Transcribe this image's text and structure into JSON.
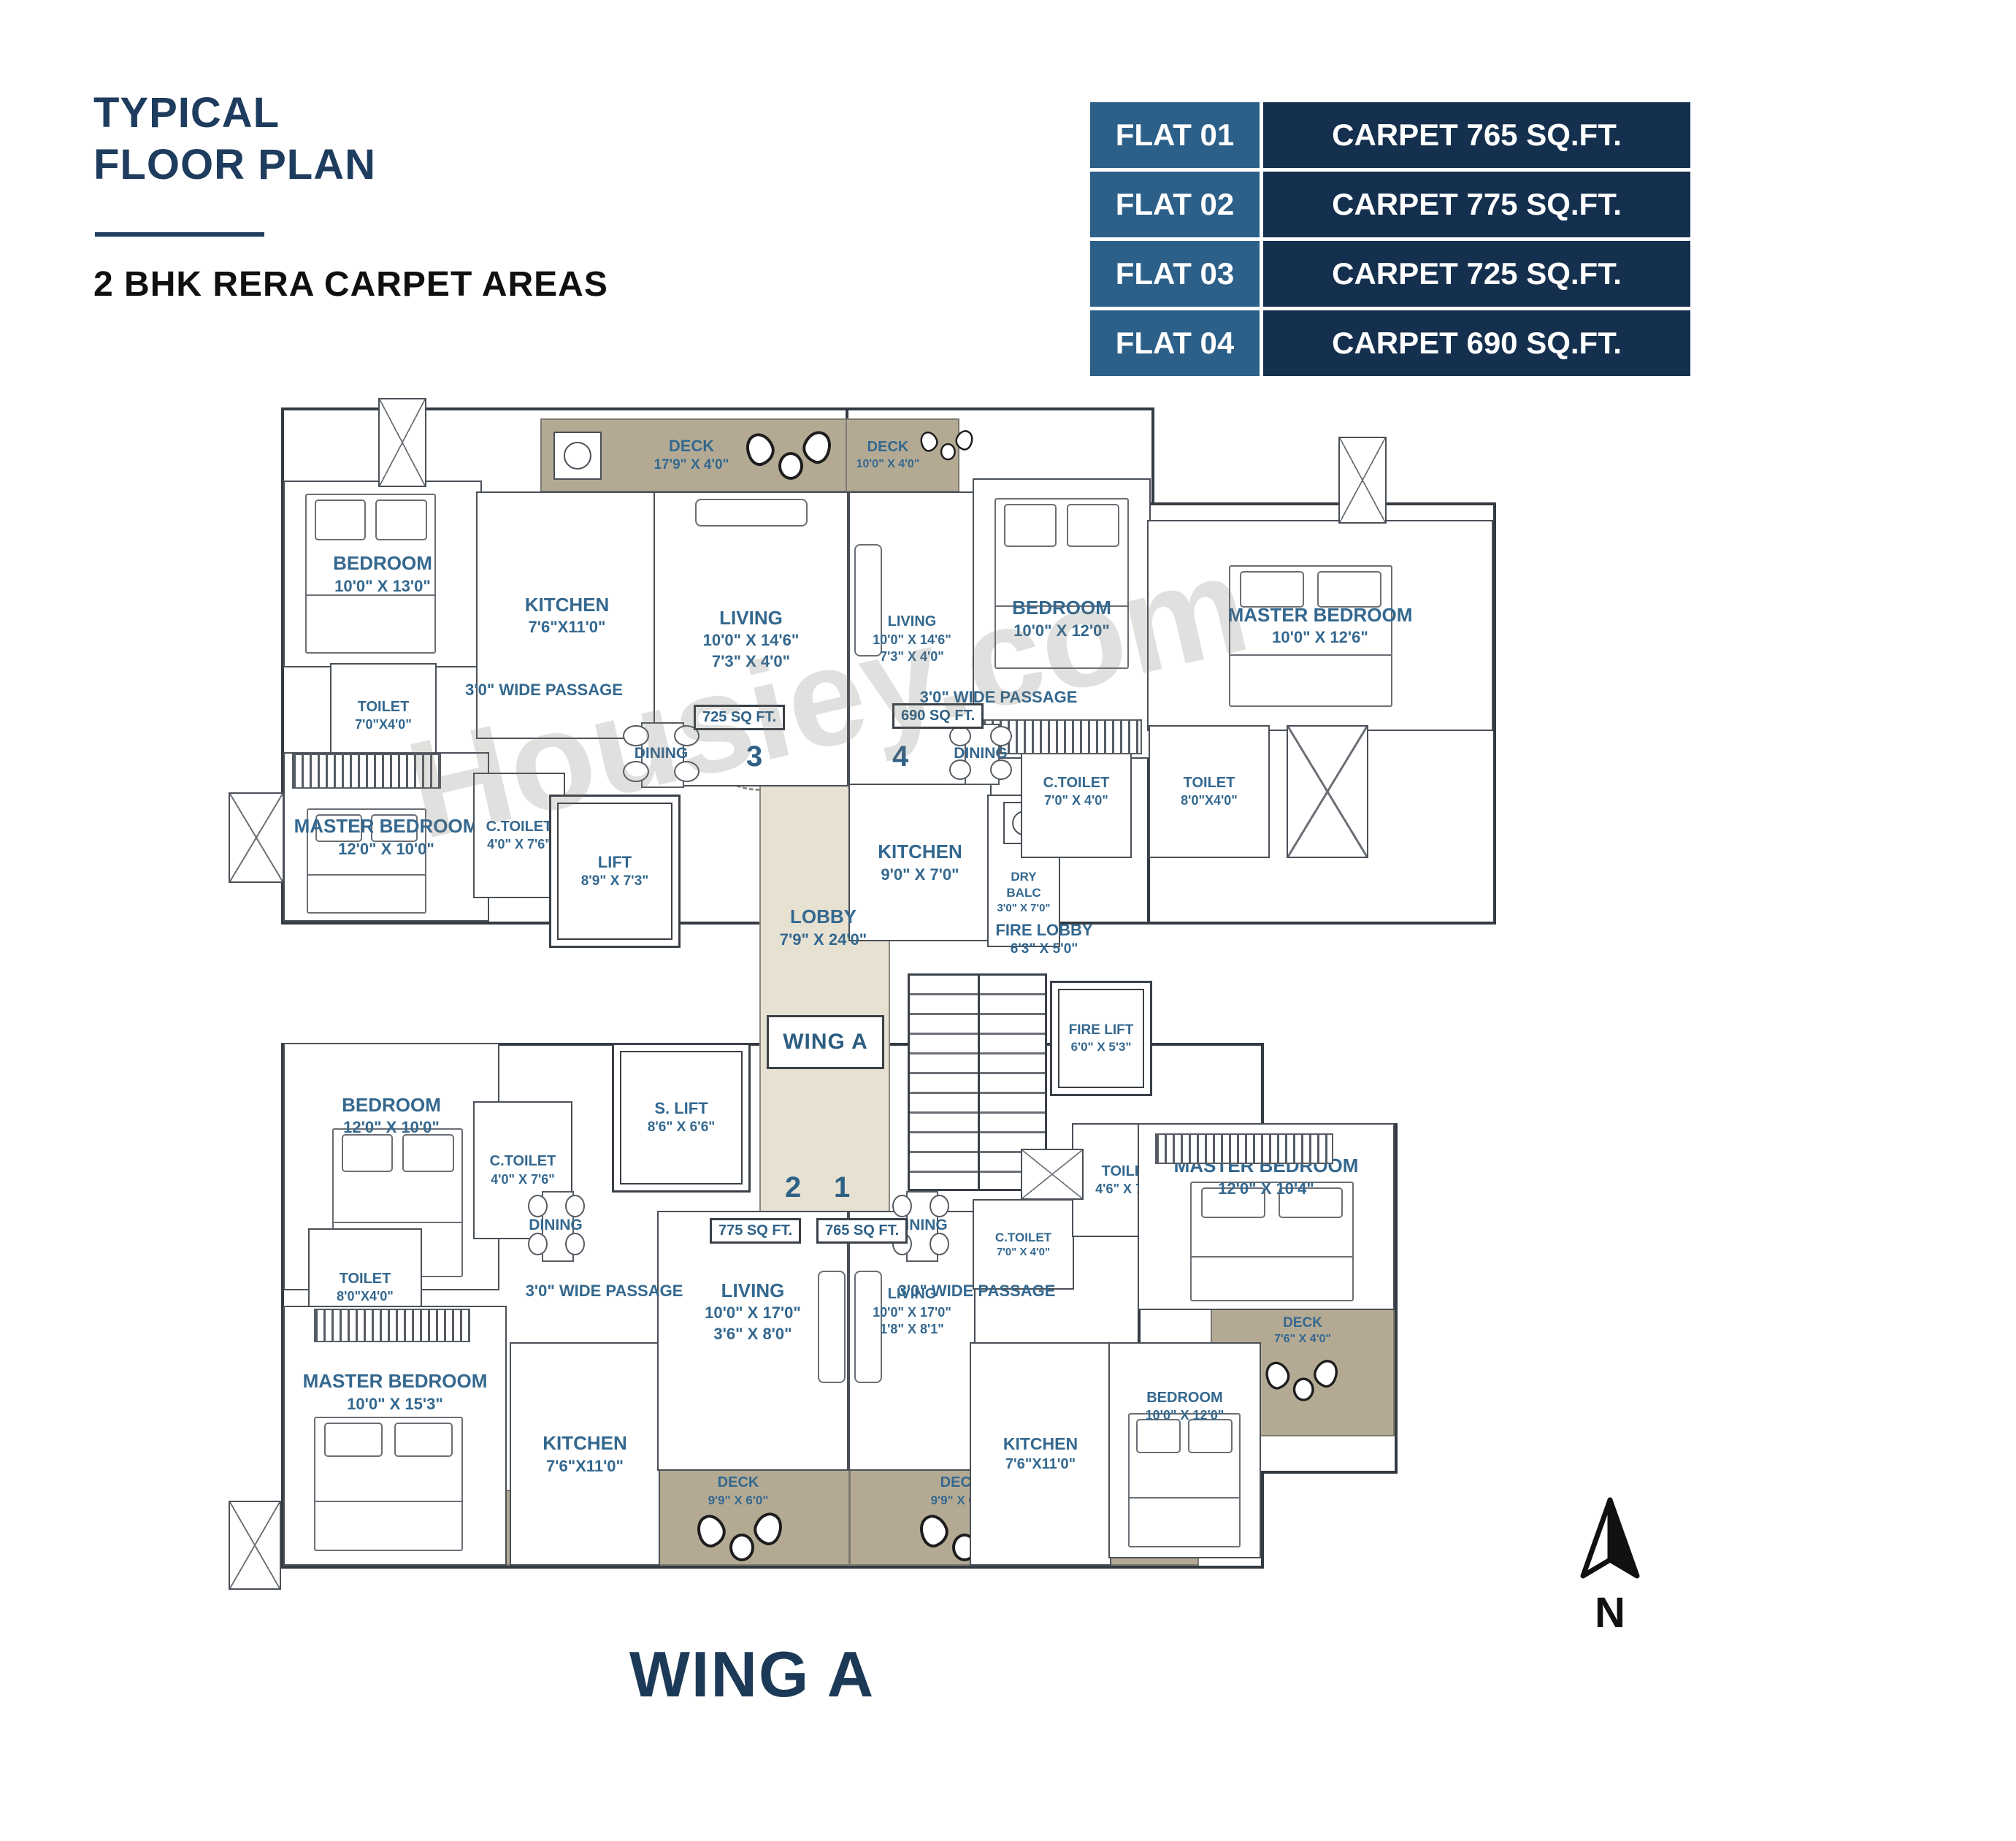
{
  "header": {
    "title": "TYPICAL\nFLOOR PLAN",
    "subtitle": "2 BHK RERA CARPET AREAS"
  },
  "table": {
    "rows": [
      {
        "flat": "FLAT 01",
        "carpet": "CARPET 765 SQ.FT."
      },
      {
        "flat": "FLAT 02",
        "carpet": "CARPET 775 SQ.FT."
      },
      {
        "flat": "FLAT 03",
        "carpet": "CARPET 725 SQ.FT."
      },
      {
        "flat": "FLAT 04",
        "carpet": "CARPET 690 SQ.FT."
      }
    ]
  },
  "watermark": {
    "text": "Housiey.com"
  },
  "plan": {
    "footer_label": "WING A",
    "north_label": "N",
    "core": {
      "lobby": {
        "name": "LOBBY",
        "dims": "7'9\" X 24'0\""
      },
      "wing_box": "WING A",
      "fire_lobby": {
        "name": "FIRE LOBBY",
        "dims": "6'3\" X 5'0\""
      },
      "fire_lift": {
        "name": "FIRE LIFT",
        "dims": "6'0\" X 5'3\""
      },
      "lift": {
        "name": "LIFT",
        "dims": "8'9\" X 7'3\""
      },
      "s_lift": {
        "name": "S. LIFT",
        "dims": "8'6\" X 6'6\""
      },
      "door_numbers": {
        "n1": "1",
        "n2": "2",
        "n3": "3",
        "n4": "4"
      }
    },
    "flat3": {
      "area_tag": "725 SQ FT.",
      "deck": {
        "name": "DECK",
        "dims": "17'9\" X 4'0\""
      },
      "kitchen": {
        "name": "KITCHEN",
        "dims": "7'6\"X11'0\""
      },
      "bedroom": {
        "name": "BEDROOM",
        "dims": "10'0\" X 13'0\""
      },
      "living": {
        "name": "LIVING",
        "dims": "10'0\" X 14'6\"\n7'3\" X 4'0\""
      },
      "toilet": {
        "name": "TOILET",
        "dims": "7'0\"X4'0\""
      },
      "master": {
        "name": "MASTER BEDROOM",
        "dims": "12'0\" X 10'0\""
      },
      "ctoilet": {
        "name": "C.TOILET",
        "dims": "4'0\" X 7'6\""
      },
      "dining": "DINING",
      "passage": "3'0\" WIDE PASSAGE"
    },
    "flat4": {
      "area_tag": "690 SQ FT.",
      "deck": {
        "name": "DECK",
        "dims": "10'0\" X 4'0\""
      },
      "living": {
        "name": "LIVING",
        "dims": "10'0\" X 14'6\"\n7'3\" X 4'0\""
      },
      "bedroom": {
        "name": "BEDROOM",
        "dims": "10'0\" X 12'0\""
      },
      "master": {
        "name": "MASTER BEDROOM",
        "dims": "10'0\" X 12'6\""
      },
      "kitchen": {
        "name": "KITCHEN",
        "dims": "9'0\" X 7'0\""
      },
      "dry_balc": {
        "name": "DRY\nBALC",
        "dims": "3'0\" X 7'0\""
      },
      "ctoilet": {
        "name": "C.TOILET",
        "dims": "7'0\" X 4'0\""
      },
      "toilet": {
        "name": "TOILET",
        "dims": "8'0\"X4'0\""
      },
      "dining": "DINING",
      "passage": "3'0\" WIDE PASSAGE"
    },
    "flat2": {
      "area_tag": "775 SQ FT.",
      "bedroom": {
        "name": "BEDROOM",
        "dims": "12'0\" X 10'0\""
      },
      "ctoilet": {
        "name": "C.TOILET",
        "dims": "4'0\" X 7'6\""
      },
      "toilet": {
        "name": "TOILET",
        "dims": "8'0\"X4'0\""
      },
      "master": {
        "name": "MASTER BEDROOM",
        "dims": "10'0\" X 15'3\""
      },
      "kitchen": {
        "name": "KITCHEN",
        "dims": "7'6\"X11'0\""
      },
      "living": {
        "name": "LIVING",
        "dims": "10'0\" X 17'0\"\n3'6\" X 8'0\""
      },
      "deck": {
        "name": "DECK",
        "dims": "9'9\" X 6'0\""
      },
      "dry_balcony": {
        "name": "DRY BALCONY",
        "dims": "8'0\" X 4'0\""
      },
      "dining": "DINING",
      "passage": "3'0\" WIDE PASSAGE"
    },
    "flat1": {
      "area_tag": "765 SQ FT.",
      "living": {
        "name": "LIVING",
        "dims": "10'0\" X 17'0\"\n1'8\" X 8'1\""
      },
      "ctoilet": {
        "name": "C.TOILET",
        "dims": "7'0\" X 4'0\""
      },
      "toilet": {
        "name": "TOILET",
        "dims": "4'6\" X 7'0\""
      },
      "master": {
        "name": "MASTER BEDROOM",
        "dims": "12'0\" X 10'4\""
      },
      "bedroom": {
        "name": "BEDROOM",
        "dims": "10'0\" X 12'0\""
      },
      "kitchen": {
        "name": "KITCHEN",
        "dims": "7'6\"X11'0\""
      },
      "deck": {
        "name": "DECK",
        "dims": "9'9\" X 6'0\""
      },
      "deck_side": {
        "name": "DECK",
        "dims": "7'6\" X 4'0\""
      },
      "dry_balcony": {
        "name": "DRY BALCONY",
        "dims": "8'0\" X 4'0\""
      },
      "dining": "DINING",
      "passage": "3'0\" WIDE PASSAGE"
    }
  },
  "colors": {
    "accent_navy": "#1e3c5e",
    "label_blue": "#34688f",
    "table_flat_bg": "#2d6089",
    "table_carpet_bg": "#14304e",
    "deck_tan": "#b4aa94",
    "lobby_beige": "#e7e1d2"
  }
}
